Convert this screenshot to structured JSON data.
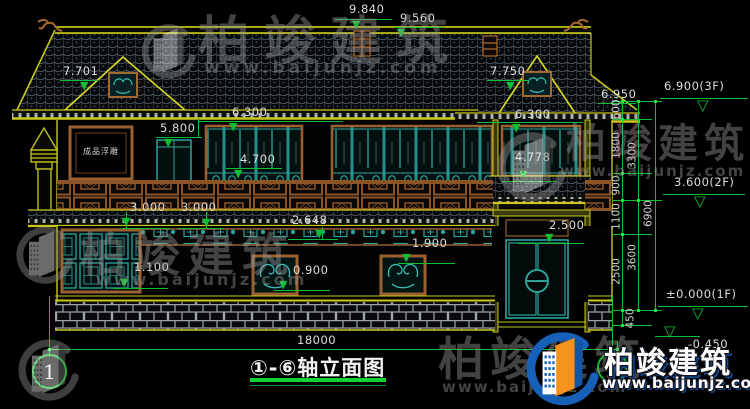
{
  "page": {
    "background": "#000000"
  },
  "drawing": {
    "title": "①-⑥轴立面图",
    "axis_start_label": "1",
    "axis_end_label": "6",
    "relief_panel_label": "成品浮雕",
    "colors": {
      "dimension_green": "#0fbf2f",
      "roof_yellow": "#c8c81e",
      "frame_brown": "#9a6032",
      "lattice_teal": "#2ba39b",
      "text_white": "#dcdcdc",
      "logo_blue": "#1660b8",
      "logo_orange": "#f6921e"
    }
  },
  "dimensions": {
    "overall_width": "18000",
    "horizontal": [
      {
        "label": "9.840",
        "tx": 349,
        "ty": 3,
        "ax": 352,
        "ay": 20
      },
      {
        "label": "9.560",
        "tx": 400,
        "ty": 12,
        "ax": 397,
        "ay": 28
      },
      {
        "label": "7.701",
        "tx": 63,
        "ty": 65,
        "ax": 80,
        "ay": 81
      },
      {
        "label": "7.750",
        "tx": 490,
        "ty": 65,
        "ax": 506,
        "ay": 81
      },
      {
        "label": "6.950",
        "tx": 601,
        "ty": 88,
        "ax": null,
        "ay": null
      },
      {
        "label": "6.300",
        "tx": 232,
        "ty": 106,
        "ax": 229,
        "ay": 122
      },
      {
        "label": "6.300",
        "tx": 515,
        "ty": 108,
        "ax": 512,
        "ay": 123
      },
      {
        "label": "5.800",
        "tx": 160,
        "ty": 122,
        "ax": 164,
        "ay": 138
      },
      {
        "label": "4.700",
        "tx": 240,
        "ty": 153,
        "ax": 234,
        "ay": 169
      },
      {
        "label": "4.778",
        "tx": 515,
        "ty": 151,
        "ax": 519,
        "ay": 170
      },
      {
        "label": "3.000",
        "tx": 130,
        "ty": 201,
        "ax": 122,
        "ay": 217
      },
      {
        "label": "3.000",
        "tx": 181,
        "ty": 201,
        "ax": 202,
        "ay": 218
      },
      {
        "label": "2.648",
        "tx": 292,
        "ty": 214,
        "ax": 315,
        "ay": 229
      },
      {
        "label": "1.100",
        "tx": 134,
        "ty": 261,
        "ax": 120,
        "ay": 278
      },
      {
        "label": "0.900",
        "tx": 293,
        "ty": 264,
        "ax": 279,
        "ay": 280
      },
      {
        "label": "1.900",
        "tx": 412,
        "ty": 237,
        "ax": 402,
        "ay": 253
      },
      {
        "label": "2.500",
        "tx": 549,
        "ty": 219,
        "ax": 545,
        "ay": 233
      },
      {
        "label": "18000",
        "tx": 297,
        "ty": 334,
        "ax": null,
        "ay": null
      }
    ],
    "vertical": [
      {
        "label": "600",
        "x": 617,
        "y": 110
      },
      {
        "label": "1800",
        "x": 617,
        "y": 146
      },
      {
        "label": "900",
        "x": 617,
        "y": 186
      },
      {
        "label": "1100",
        "x": 617,
        "y": 217
      },
      {
        "label": "2500",
        "x": 617,
        "y": 272
      },
      {
        "label": "450",
        "x": 631,
        "y": 319
      },
      {
        "label": "3300",
        "x": 633,
        "y": 156
      },
      {
        "label": "3600",
        "x": 633,
        "y": 258
      },
      {
        "label": "6900",
        "x": 649,
        "y": 214
      }
    ],
    "elevation_markers": [
      {
        "label": "6.900(3F)",
        "tx": 664,
        "ty": 80,
        "ax": 697,
        "ay": 99
      },
      {
        "label": "3.600(2F)",
        "tx": 674,
        "ty": 176,
        "ax": 694,
        "ay": 195
      },
      {
        "label": "±0.000(1F)",
        "tx": 666,
        "ty": 288,
        "ax": 692,
        "ay": 307
      },
      {
        "label": "-0.450",
        "tx": 688,
        "ty": 338,
        "ax": 664,
        "ay": 325
      }
    ]
  },
  "watermark": {
    "company": "柏竣建筑",
    "website": "www.baijunjz.com"
  }
}
